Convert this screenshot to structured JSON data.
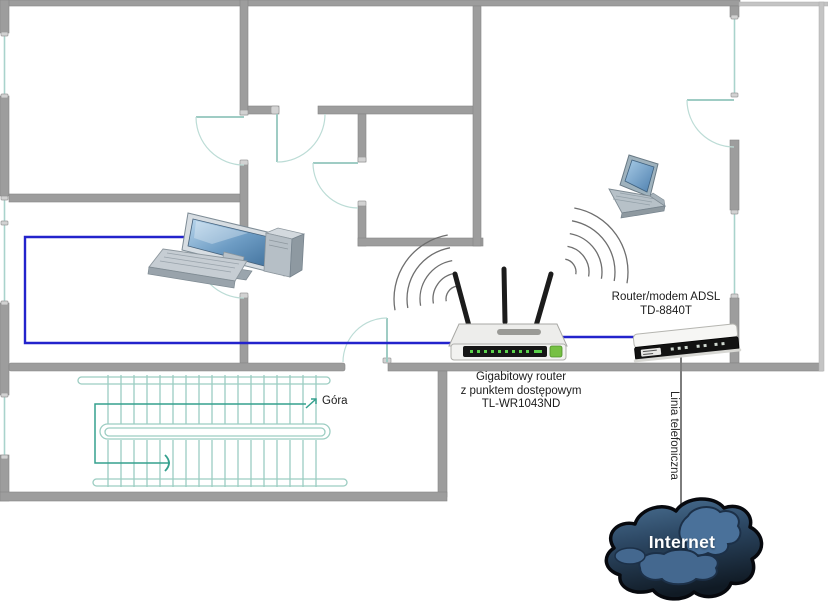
{
  "diagram": {
    "type": "home-network-floor-plan",
    "labels": {
      "wireless_router": {
        "line1": "Gigabitowy router",
        "line2": "z punktem dostępowym",
        "line3": "TL-WR1043ND"
      },
      "adsl_modem": {
        "line1": "Router/modem ADSL",
        "line2": "TD-8840T"
      },
      "phone_line": "Linia telefoniczna",
      "stairs_direction": "Góra",
      "internet_cloud": "Internet"
    },
    "icons": [
      "desktop-computer-icon",
      "laptop-icon",
      "wireless-router-icon",
      "adsl-modem-icon",
      "wifi-waves-icon",
      "stairs-icon",
      "internet-cloud-icon"
    ],
    "colors": {
      "wall": "#9d9d9d",
      "balcony_wall": "#c4c4c4",
      "door_window": "#a9d3cc",
      "stairs": "#9ccdc2",
      "walk_line": "#35a08e",
      "ethernet_cable": "#2323cc",
      "phone_line": "#7d7d7d",
      "wifi_waves": "#6e6e6e",
      "cloud_fill_dark": "#16222f",
      "cloud_fill_light": "#4c7396",
      "label_text": "#1c1c1c"
    }
  }
}
